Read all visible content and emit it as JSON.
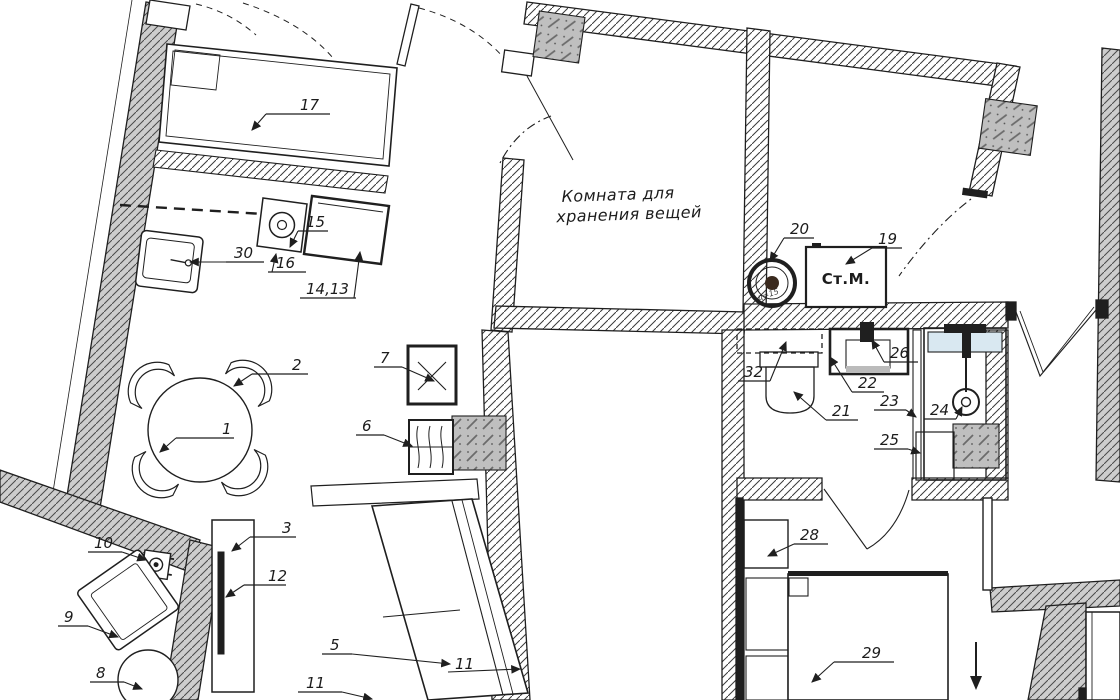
{
  "title": "Apartment floor plan with numbered furniture and fixtures",
  "storage_room": {
    "line1": "Комната для",
    "line2": "хранения вещей"
  },
  "washing_machine_label": "Ст.М.",
  "fan_note": "д=15",
  "labels": {
    "l1": "1",
    "l2": "2",
    "l3": "3",
    "l5": "5",
    "l6": "6",
    "l7": "7",
    "l8": "8",
    "l9": "9",
    "l10": "10",
    "l11a": "11",
    "l11b": "11",
    "l12": "12",
    "l14_13": "14,13",
    "l15": "15",
    "l16": "16",
    "l17": "17",
    "l19": "19",
    "l20": "20",
    "l21": "21",
    "l22": "22",
    "l23": "23",
    "l24": "24",
    "l25": "25",
    "l26": "26",
    "l28": "28",
    "l29": "29",
    "l30": "30",
    "l32": "32"
  },
  "colors": {
    "line": "#1f1f1f",
    "wall_gray": "#cdcdcd",
    "shaft_gray": "#bfbfbf",
    "shelf_blue": "#d9e8f1",
    "accent_orange": "#d4874f"
  }
}
